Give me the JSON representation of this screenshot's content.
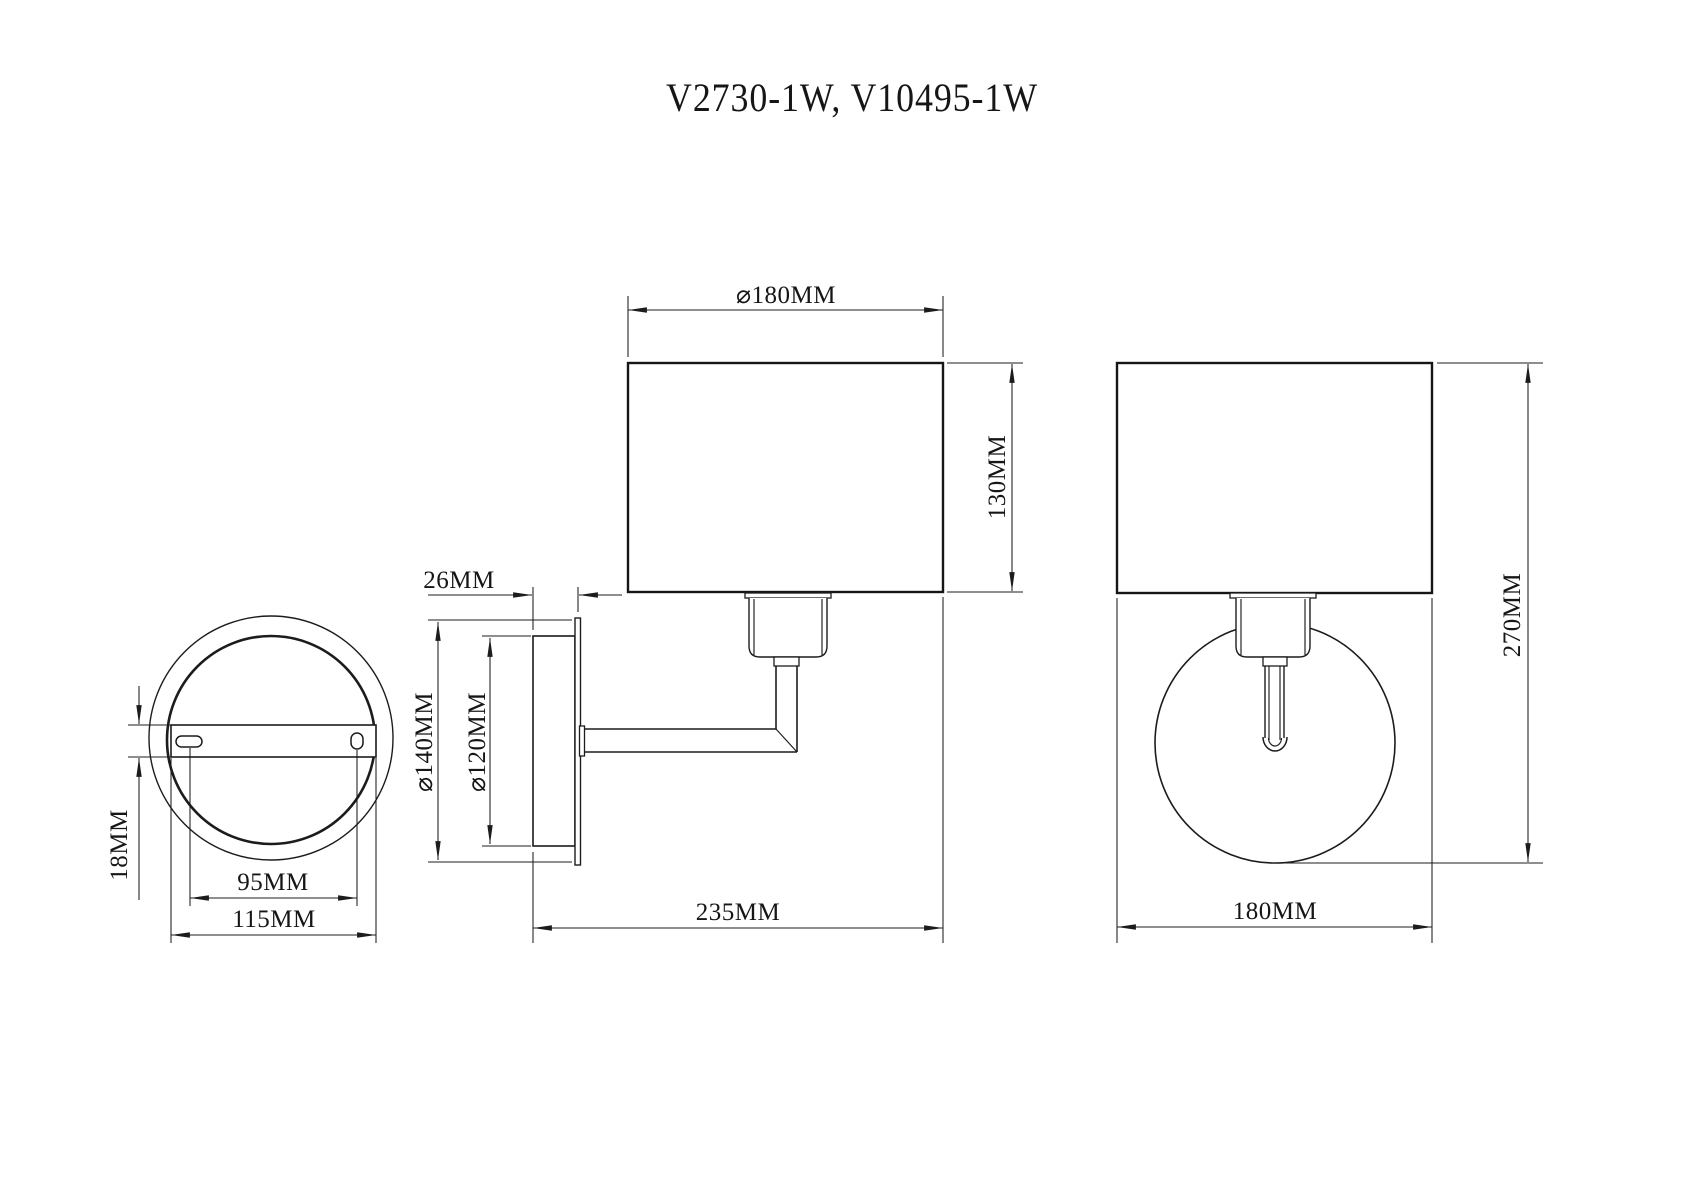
{
  "title": "V2730-1W, V10495-1W",
  "drawing": {
    "type": "wall-lamp technical drawing, three orthographic views",
    "colors": {
      "line": "#1c1c1c",
      "background": "#ffffff"
    }
  },
  "views": {
    "back_plate": {
      "name": "wall-plate back view",
      "dims": {
        "bracket_height": "18MM",
        "hole_spacing": "95MM",
        "bracket_width": "115MM"
      }
    },
    "side": {
      "name": "side view",
      "dims": {
        "shade_diameter": "⌀180MM",
        "shade_height": "130MM",
        "plate_depth": "26MM",
        "plate_diameter": "⌀140MM",
        "plate_inner_diameter": "⌀120MM",
        "total_projection": "235MM"
      }
    },
    "front": {
      "name": "front view",
      "dims": {
        "total_height": "270MM",
        "shade_width": "180MM"
      }
    }
  }
}
